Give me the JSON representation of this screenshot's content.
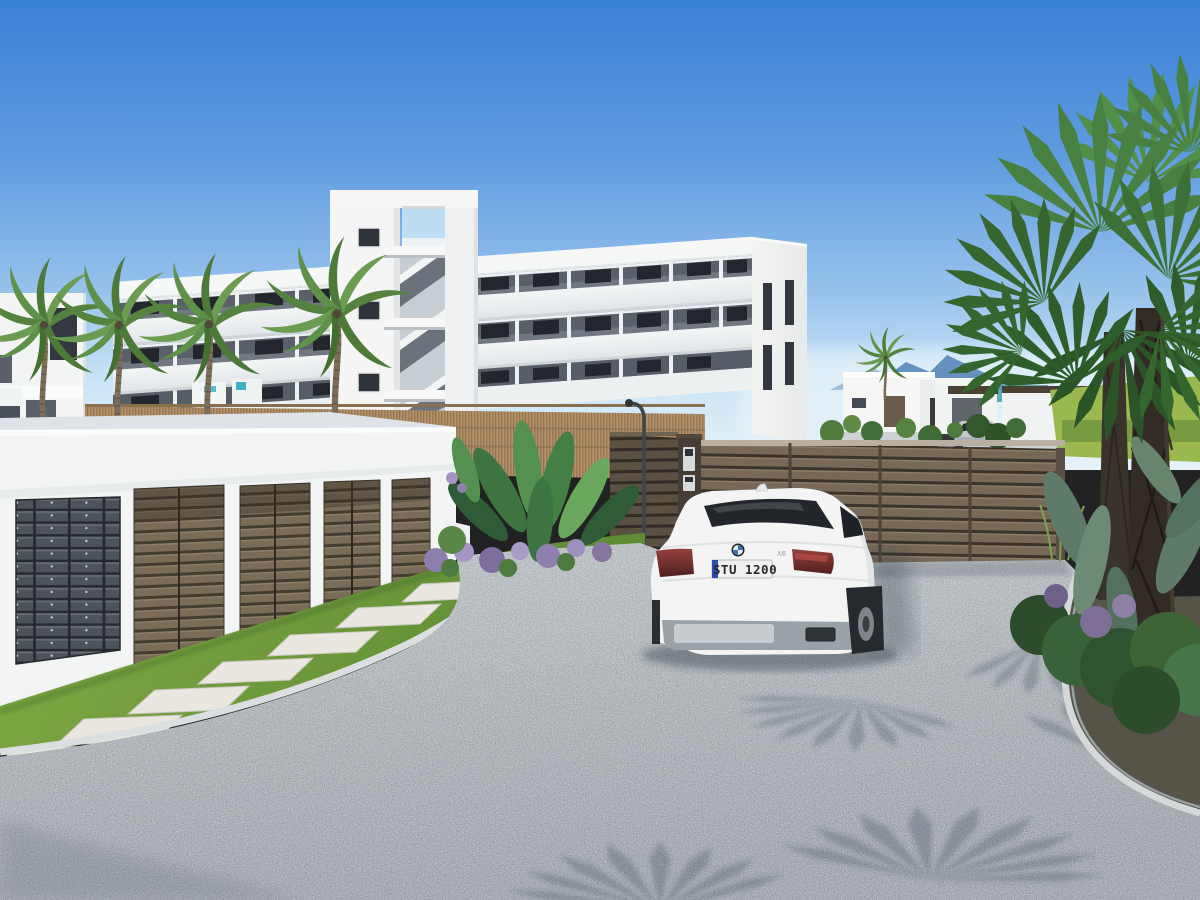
{
  "image": {
    "kind": "3d-architectural-exterior-render",
    "subject": "new-build apartment complex entrance with garages, mailboxes, gravel driveway, SUV and palm trees"
  },
  "sky": {
    "top_color": "#3a80d6",
    "mid_color": "#74a9e5",
    "horizon_color": "#e2f1fa"
  },
  "building": {
    "wall_color": "#f5f6f5",
    "floors": 3,
    "balcony_recess_color": "#59606a",
    "window_color": "#23272d",
    "has_stair_tower": true,
    "has_roof_frame_opening": true,
    "gable_color": "#f2f3f1"
  },
  "left_building": {
    "wall_color": "#f3f5f5"
  },
  "background_villas": {
    "wall_color": "#f4f6f5",
    "door_color": "#6b5a47",
    "pergola_color": "#4a4034"
  },
  "garage": {
    "door_count": 4,
    "door_color": "#7b6c59",
    "slat_gap_color": "#453c30",
    "structure_color": "#f3f5f5",
    "roof_color": "#dde3e7"
  },
  "mailboxes": {
    "columns": 3,
    "rows": 12,
    "panel_color": "#3f444a",
    "door_color": "#4d535a"
  },
  "fences": {
    "reed_color": "#b2916c",
    "slat_fence_color": "#776857",
    "gate_color": "#5b5143",
    "pillar_color": "#463d34",
    "intercom_panel_count": 2
  },
  "lamp": {
    "pole_color": "#3f4449"
  },
  "car": {
    "brand": "BMW",
    "license_plate": "STU 1200",
    "model_badge": "X6",
    "body_color": "#f3f4f3",
    "glass_color": "#22262b",
    "plate_eu_band_color": "#2b4fa8",
    "tail_light_color": "#7e3331",
    "bumper_color": "#9aa1a7"
  },
  "background_car": {
    "body_color": "#c3c8cc",
    "glass_color": "#2a2e33"
  },
  "landscape": {
    "front_palm_count": 4,
    "right_palm_type": "fan palm",
    "palm_greens": [
      "#35662f",
      "#478040",
      "#5c9a4a"
    ],
    "grass_color": "#79a140",
    "paver_count": 8,
    "paver_color": "#e9e7e0",
    "gravel_color": "#a6adb2",
    "purple_flower_color": "#8f7fae",
    "mountain_color": "#6591bf",
    "sea_color": "#47a0ac",
    "lawn_color": "#9ab84e"
  }
}
